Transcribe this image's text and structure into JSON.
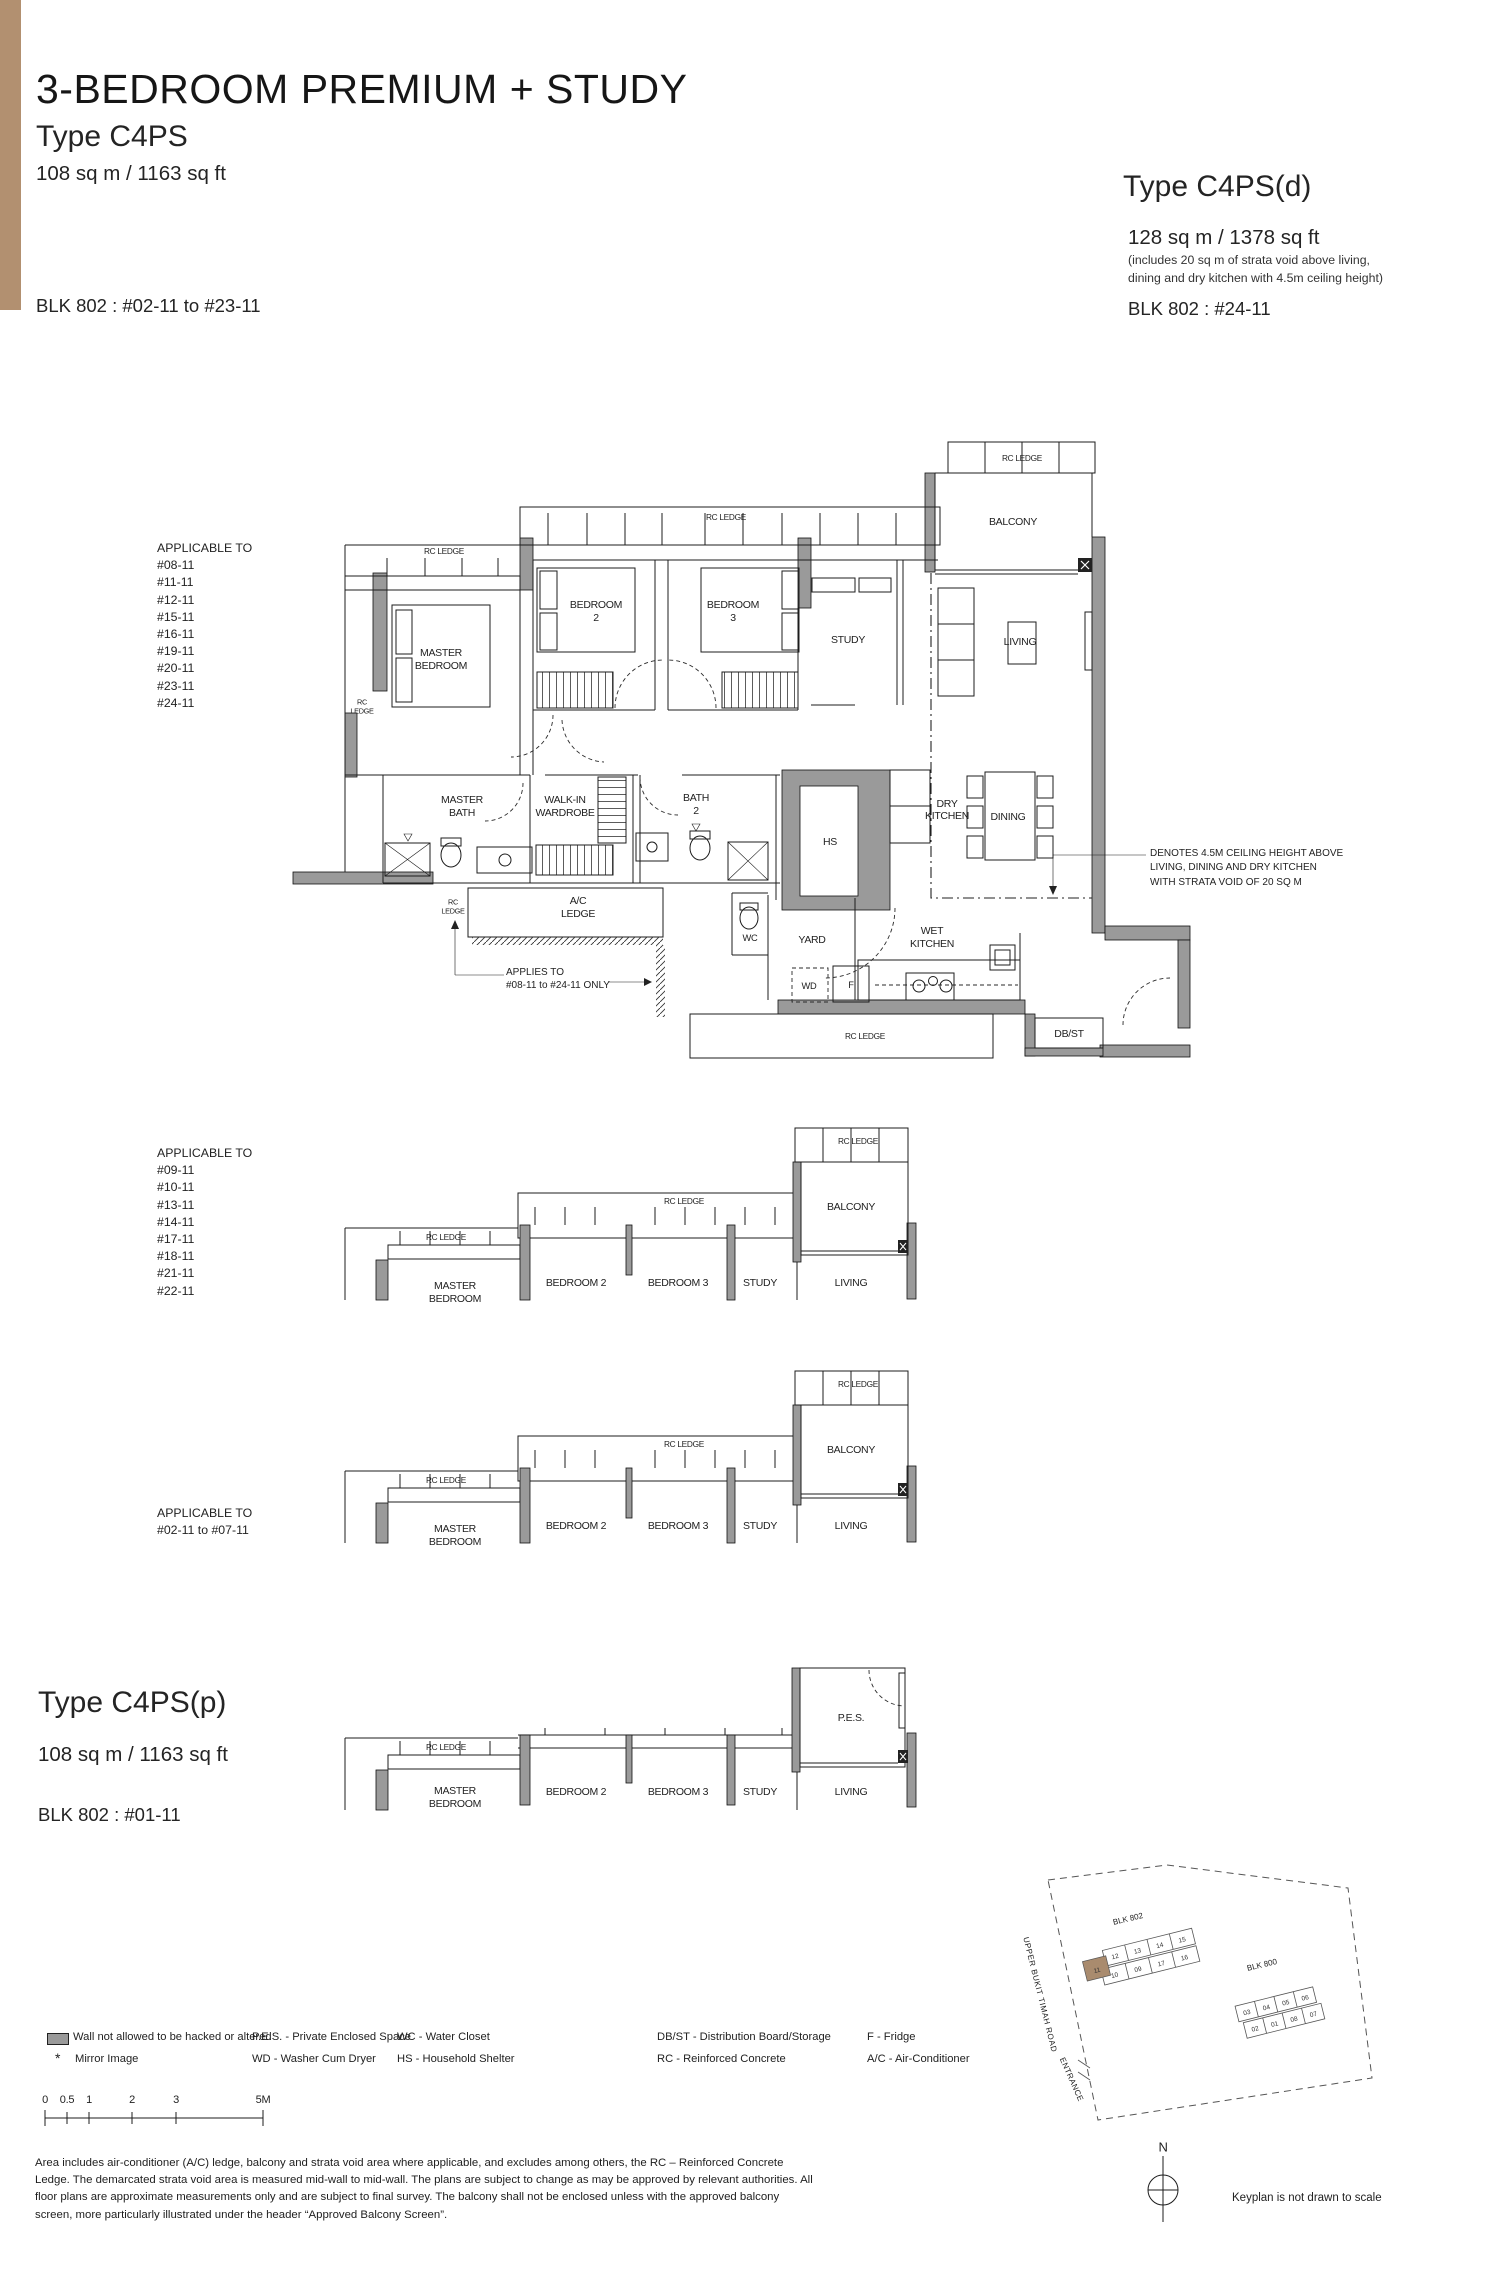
{
  "header": {
    "title": "3-BEDROOM PREMIUM + STUDY",
    "left_type": "Type C4PS",
    "left_area": "108 sq m / 1163 sq ft",
    "left_blk": "BLK 802 : #02-11 to #23-11",
    "right_type": "Type C4PS(d)",
    "right_area": "128 sq m / 1378 sq ft",
    "right_note1": "(includes 20 sq m of strata void above living,",
    "right_note2": "dining and dry kitchen with 4.5m ceiling height)",
    "right_blk": "BLK 802 : #24-11"
  },
  "type_p": {
    "name": "Type C4PS(p)",
    "area": "108 sq m / 1163 sq ft",
    "blk": "BLK 802 : #01-11"
  },
  "applicable1": {
    "title": "APPLICABLE TO",
    "units": [
      "#08-11",
      "#11-11",
      "#12-11",
      "#15-11",
      "#16-11",
      "#19-11",
      "#20-11",
      "#23-11",
      "#24-11"
    ]
  },
  "applicable2": {
    "title": "APPLICABLE TO",
    "units": [
      "#09-11",
      "#10-11",
      "#13-11",
      "#14-11",
      "#17-11",
      "#18-11",
      "#21-11",
      "#22-11"
    ]
  },
  "applicable3": {
    "title": "APPLICABLE TO",
    "range": "#02-11 to #07-11"
  },
  "labels": {
    "rc_ledge": "RC LEDGE",
    "rc": "RC",
    "ledge": "LEDGE",
    "master": "MASTER",
    "bedroom": "BEDROOM",
    "two": "2",
    "three": "3",
    "bedroom2": "BEDROOM 2",
    "bedroom3": "BEDROOM 3",
    "study": "STUDY",
    "living": "LIVING",
    "balcony": "BALCONY",
    "bath": "BATH",
    "walk_in": "WALK-IN",
    "wardrobe": "WARDROBE",
    "hs": "HS",
    "dry": "DRY",
    "kitchen": "KITCHEN",
    "dining": "DINING",
    "ac": "A/C",
    "wc": "WC",
    "yard": "YARD",
    "wet": "WET",
    "wd": "WD",
    "f": "F",
    "dbst": "DB/ST",
    "pes": "P.E.S."
  },
  "annotations": {
    "applies1": "APPLIES TO",
    "applies2": "#08-11 to #24-11 ONLY",
    "denotes1": "DENOTES 4.5M CEILING HEIGHT ABOVE",
    "denotes2": "LIVING, DINING AND DRY KITCHEN",
    "denotes3": "WITH STRATA VOID OF 20 SQ M"
  },
  "legend": {
    "wall": "Wall not allowed to be hacked or altered",
    "mirror_symbol": "*",
    "mirror": "Mirror Image",
    "pes": "P.E.S. - Private Enclosed Space",
    "wd": "WD - Washer Cum Dryer",
    "wc": "WC - Water Closet",
    "hs": "HS - Household Shelter",
    "dbst": "DB/ST - Distribution Board/Storage",
    "rc": "RC - Reinforced Concrete",
    "f": "F - Fridge",
    "ac": "A/C - Air-Conditioner"
  },
  "scale": {
    "ticks": [
      "0",
      "0.5",
      "1",
      "2",
      "3",
      "5M"
    ]
  },
  "disclaimer": {
    "line1": "Area includes air-conditioner (A/C) ledge, balcony and strata void area where applicable, and excludes among others, the RC – Reinforced Concrete",
    "line2": "Ledge. The demarcated strata void area is measured mid-wall to mid-wall. The plans are subject to change as may be approved by relevant authorities. All",
    "line3": "floor plans are approximate measurements only and are subject to final survey. The balcony shall not be enclosed unless with the approved balcony",
    "line4": "screen, more particularly illustrated under the header “Approved Balcony Screen”."
  },
  "keyplan": {
    "blk802": "BLK 802",
    "blk800": "BLK 800",
    "road": "UPPER BUKIT TIMAH ROAD",
    "entrance": "ENTRANCE",
    "north": "N",
    "note": "Keyplan is not drawn to scale",
    "units_802": [
      "09",
      "10",
      "11",
      "12",
      "13",
      "14",
      "15",
      "16",
      "17"
    ],
    "units_800": [
      "01",
      "02",
      "03",
      "04",
      "05",
      "06",
      "07",
      "08"
    ]
  },
  "colors": {
    "accent": "#b29070",
    "wall_gray": "#9a9a9a",
    "highlight_unit": "#a98b6e"
  }
}
